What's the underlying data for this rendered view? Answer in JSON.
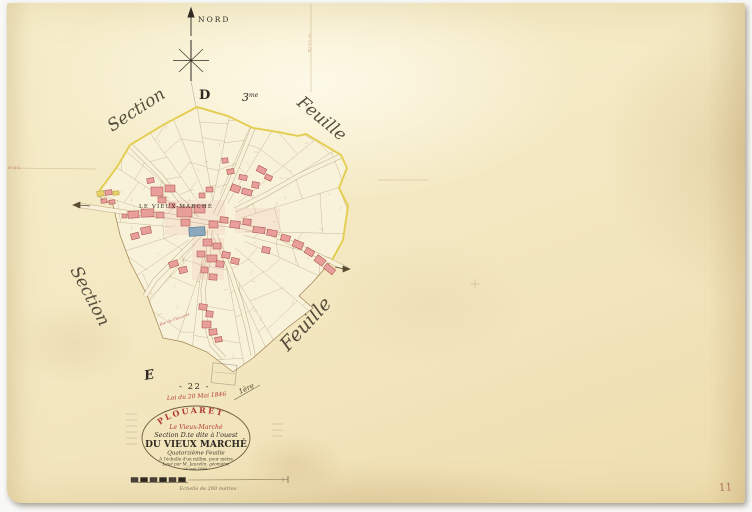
{
  "compass": {
    "north_label": "NORD"
  },
  "sheet_heading": {
    "section_letter": "D",
    "sheet_number": "3",
    "sheet_ordinal": "me"
  },
  "corner_scripts": {
    "top_left": "Section",
    "top_right": "Feuille",
    "bottom_left": "Section",
    "bottom_right": "Feuille"
  },
  "map": {
    "village_label": "LE VIEUX-MARCHÉ",
    "road_annotation": "Rte de Plouaret"
  },
  "notes": {
    "letter_e": "E",
    "sheet_no": "- 22 -",
    "loi": "Loi du 20 Mai 1846",
    "paraph": "1ère",
    "margin_left_red": "N° 4 G.",
    "margin_top_vertical": "N° 3 V. Ch.",
    "page_number": "11"
  },
  "cartouche": {
    "stamp": "PLOUARET",
    "commune": "Le Vieux-Marché",
    "section_line": "Section D.te dite à l'ouest",
    "title": "DU VIEUX MARCHÉ",
    "feuille_line": "Quatorzième Feuille",
    "echelle_line": "A l'échelle d'un millim. pour mètre",
    "leve_line": "Levé par M. Jauzelin, géomètre",
    "date_line": "20 mai 1846."
  },
  "scale_bar": {
    "label": "Echelle de 200 mètres"
  },
  "colors": {
    "boundary_yellow": "#e7cf4e",
    "building_pink": "#e89f9b",
    "building_stroke": "#a34840",
    "church_blue": "#8ca8bd",
    "ink": "#2e2a22",
    "red_ink": "#b23b30",
    "parcel_line": "#9c7c50"
  }
}
